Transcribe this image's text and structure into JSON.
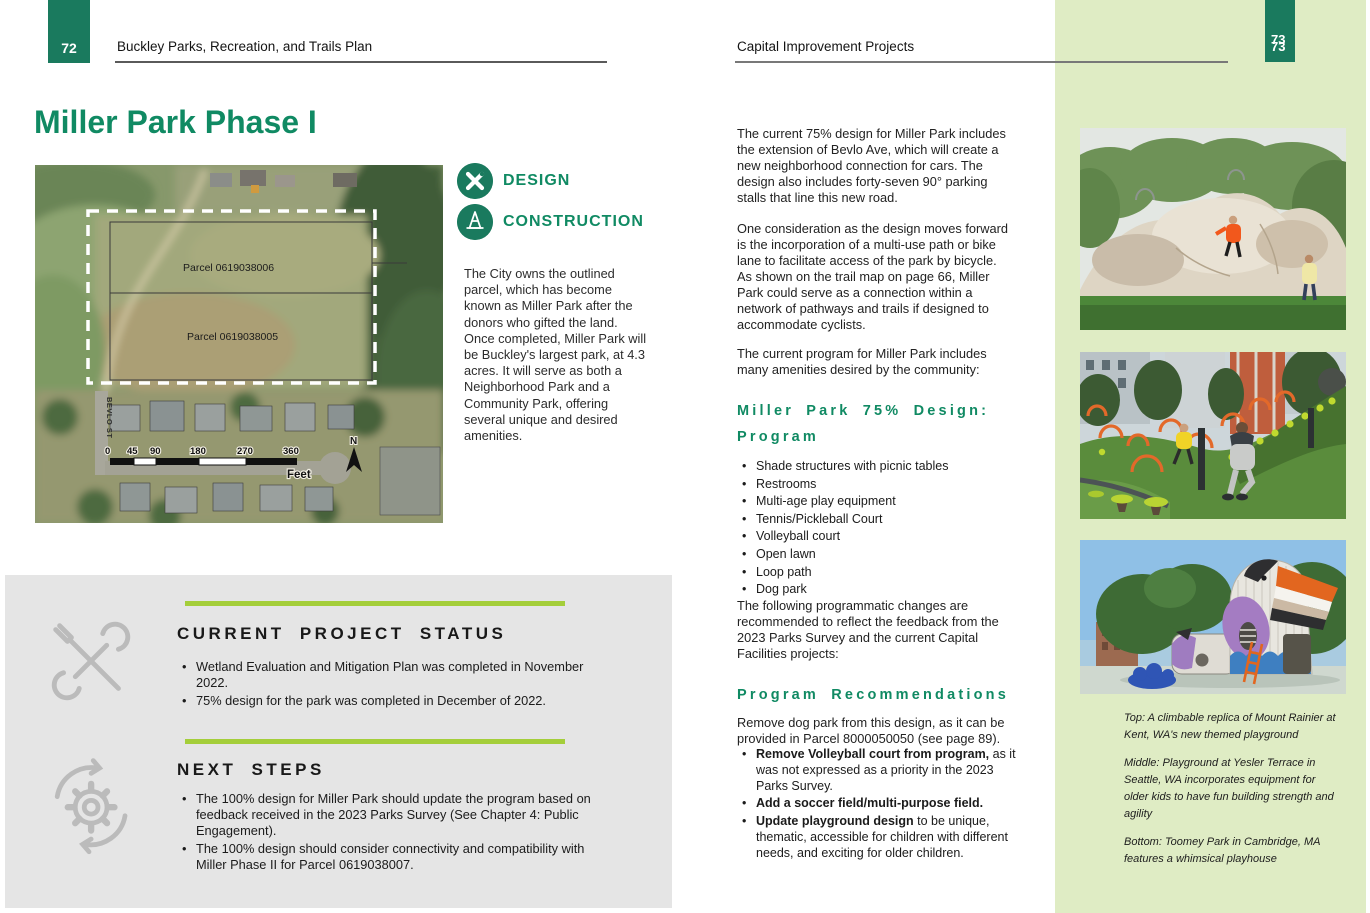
{
  "colors": {
    "brand_green": "#108a63",
    "tab_green": "#1a7a5e",
    "lime_accent": "#a4ce3a",
    "panel_green": "#dfecc4",
    "status_box_gray": "#e5e5e5"
  },
  "page_left": {
    "page_number": "72",
    "header": "Buckley Parks, Recreation, and Trails Plan",
    "title": "Miller Park Phase I",
    "map": {
      "parcel_labels": [
        "Parcel 0619038006",
        "Parcel 0619038005"
      ],
      "street_label": "BEVLO ST",
      "scale_ticks": [
        "0",
        "45",
        "90",
        "180",
        "270",
        "360"
      ],
      "scale_unit": "Feet",
      "north_label": "N"
    },
    "tags": [
      {
        "label": "DESIGN"
      },
      {
        "label": "CONSTRUCTION"
      }
    ],
    "intro": "The City owns the outlined parcel, which has become known as Miller Park after the donors who gifted the land. Once completed, Miller Park will be Buckley's largest park, at 4.3 acres. It will serve as both a Neighborhood Park and a Community Park, offering several unique and desired amenities.",
    "status_box": {
      "current_title": "CURRENT PROJECT STATUS",
      "current_bullets": [
        "Wetland Evaluation and Mitigation Plan was completed in November 2022.",
        "75% design for the park was completed in December of 2022."
      ],
      "next_title": "NEXT STEPS",
      "next_bullets": [
        "The 100% design for Miller Park should update the program based on feedback received in the 2023 Parks Survey (See Chapter 4: Public Engagement).",
        "The 100% design should consider connectivity and compatibility with Miller Phase II for Parcel 0619038007."
      ]
    }
  },
  "page_right": {
    "page_number": "73",
    "header": "Capital Improvement Projects",
    "paragraphs": [
      "The current 75% design for Miller Park includes the extension of Bevlo Ave, which will create a new neighborhood connection for cars. The design also includes forty-seven 90° parking stalls that line this new road.",
      "One consideration as the design moves forward is the incorporation of a multi-use path or bike lane to facilitate access of the park by bicycle. As shown on the trail map on page 66, Miller Park could serve as a connection within a network of pathways and trails if designed to accommodate cyclists.",
      "The current program for Miller Park includes many amenities desired by the community:"
    ],
    "program_heading_line1": "Miller Park 75% Design:",
    "program_heading_line2": "Program",
    "program_items": [
      "Shade structures with picnic tables",
      "Restrooms",
      "Multi-age play equipment",
      "Tennis/Pickleball Court",
      "Volleyball court",
      "Open lawn",
      "Loop path",
      "Dog park"
    ],
    "changes_intro": "The following programmatic changes are recommended to reflect the feedback from the 2023 Parks Survey and the current Capital Facilities projects:",
    "recommendations_heading": "Program Recommendations",
    "recommendations_intro": "Remove dog park from this design, as it can be provided in Parcel 8000050050 (see page 89).",
    "recommendations": [
      {
        "bold": "Remove Volleyball court from program,",
        "rest": " as it was not expressed as a priority in the 2023 Parks Survey."
      },
      {
        "bold": "Add a soccer field/multi-purpose field.",
        "rest": ""
      },
      {
        "bold": "Update playground design",
        "rest": " to be unique, thematic, accessible for children with different needs, and exciting for older children."
      }
    ],
    "captions": [
      "Top: A climbable replica of Mount Rainier at Kent, WA's new themed playground",
      "Middle: Playground at Yesler Terrace in Seattle, WA incorporates equipment for older kids to have fun building strength and agility",
      "Bottom: Toomey Park in Cambridge, MA features a whimsical playhouse"
    ]
  }
}
